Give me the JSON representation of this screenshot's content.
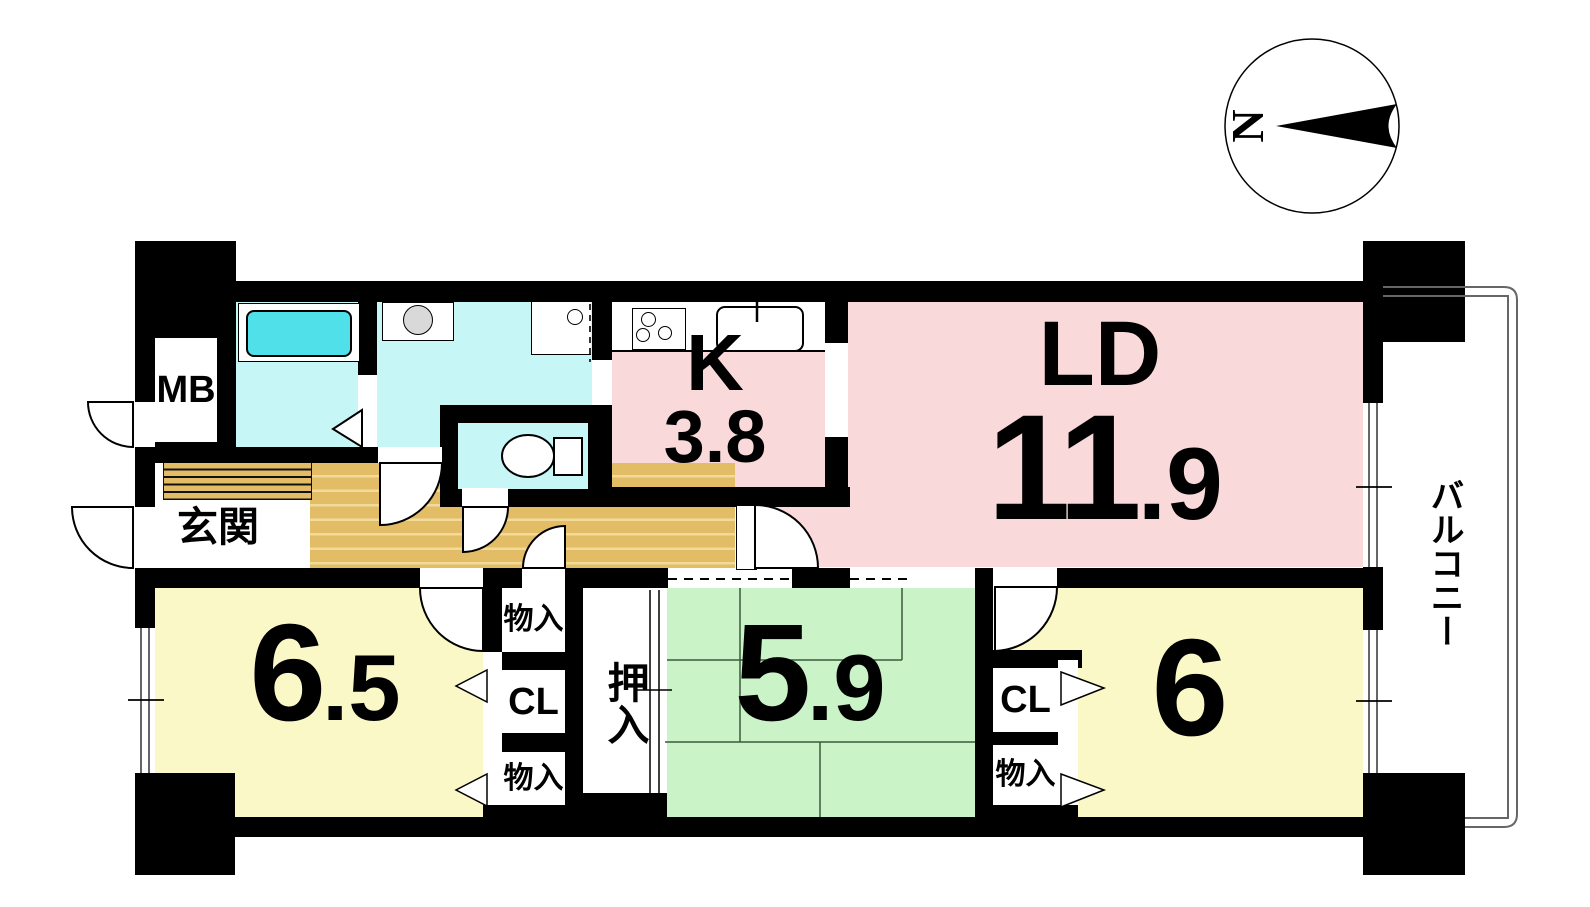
{
  "compass": {
    "north_label": "N"
  },
  "balcony": {
    "label": "バルコニー"
  },
  "rooms": {
    "living_dining": {
      "label": "LD",
      "area_main": "11",
      "area_sub": ".9"
    },
    "kitchen": {
      "label": "K",
      "area": "3.8"
    },
    "bedroom_west": {
      "area_main": "6",
      "area_sub": ".5"
    },
    "tatami_room": {
      "area_main": "5",
      "area_sub": ".9"
    },
    "bedroom_east": {
      "area": "6"
    },
    "entrance": {
      "label": "玄関"
    },
    "meter_box": {
      "label": "MB"
    }
  },
  "closets": {
    "storage_label": "物入",
    "closet_label": "CL",
    "oshiire_label": "押入"
  },
  "colors": {
    "wall": "#000000",
    "pink": "#FAD9DA",
    "yellow": "#FAF8C6",
    "green": "#CBF3C8",
    "cyan": "#C7F6F7",
    "tub": "#4FE0EA",
    "floor": "#E2BD66",
    "floor_light": "#F2DA9A",
    "washer": "#D9D9D9",
    "railing": "#666666"
  }
}
